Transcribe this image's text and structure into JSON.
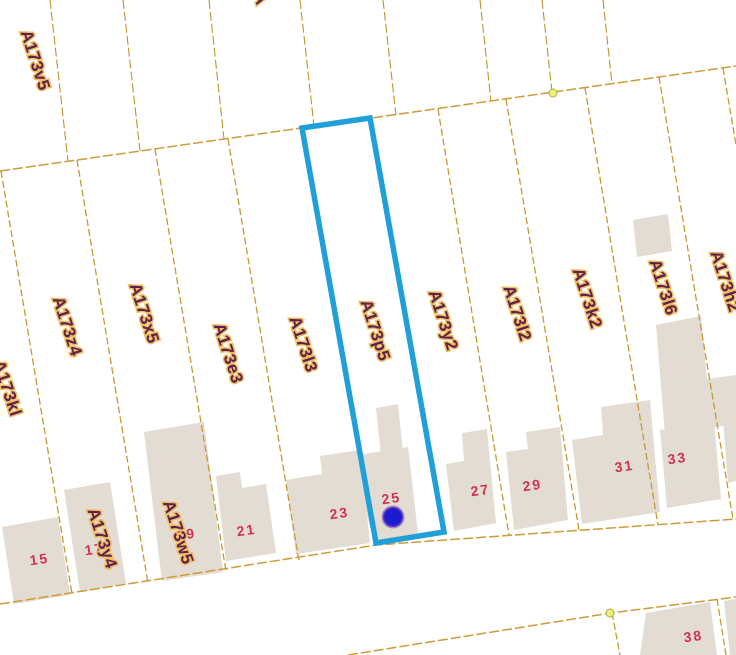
{
  "map": {
    "type": "cadastral-parcel-map",
    "colors": {
      "background": "#ffffff",
      "parcel_line": "#c49a33",
      "building_fill": "#e3dcd3",
      "parcel_label_text": "#5c2150",
      "parcel_label_halo": "#efbc5e",
      "house_number_text": "#cf3350",
      "selection_outline": "#219fd8",
      "marker_dot": "#1b1bd0",
      "vertex_node": "#eef27a"
    },
    "selected_parcel": {
      "id": "A173p5",
      "house_number": "25",
      "marker": "blue-dot"
    },
    "top_parcels": [
      {
        "id": "A173v5"
      },
      {
        "id": "A"
      }
    ],
    "parcels": [
      {
        "id": "A173kl"
      },
      {
        "id": "A173z4"
      },
      {
        "id": "A173x5"
      },
      {
        "id": "A173e3"
      },
      {
        "id": "A173l3"
      },
      {
        "id": "A173p5"
      },
      {
        "id": "A173y2"
      },
      {
        "id": "A173l2"
      },
      {
        "id": "A173k2"
      },
      {
        "id": "A173l6"
      },
      {
        "id": "A173h2"
      }
    ],
    "block_parcels": [
      {
        "id": "A173y4"
      },
      {
        "id": "A173w5"
      }
    ],
    "house_numbers": [
      {
        "n": "15"
      },
      {
        "n": "17"
      },
      {
        "n": "19"
      },
      {
        "n": "21"
      },
      {
        "n": "23"
      },
      {
        "n": "25"
      },
      {
        "n": "27"
      },
      {
        "n": "29"
      },
      {
        "n": "31"
      },
      {
        "n": "33"
      },
      {
        "n": "38"
      }
    ]
  }
}
